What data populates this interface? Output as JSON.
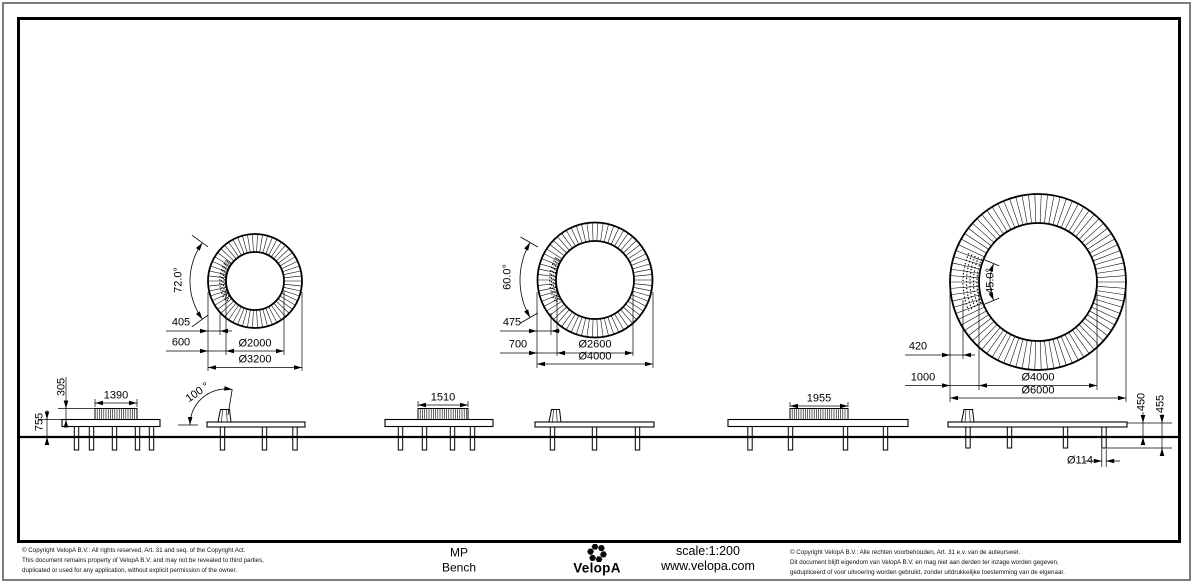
{
  "plan_views": [
    {
      "name": "circular bench plan Ø3200",
      "angle_label": "72.0°",
      "seat_offset": "405",
      "ring_width": "600",
      "inner_diameter": "Ø2000",
      "outer_diameter": "Ø3200"
    },
    {
      "name": "circular bench plan Ø4000",
      "angle_label": "60.0°",
      "seat_offset": "475",
      "ring_width": "700",
      "inner_diameter": "Ø2600",
      "outer_diameter": "Ø4000"
    },
    {
      "name": "circular bench plan Ø6000",
      "angle_label": "45.0°",
      "seat_offset": "420",
      "ring_width": "1000",
      "inner_diameter": "Ø4000",
      "outer_diameter": "Ø6000"
    }
  ],
  "elevations": {
    "backrest_height": "305",
    "overall_height": "755",
    "backrest_angle": "100 °",
    "seat_widths": [
      "1390",
      "1510",
      "1955"
    ],
    "seat_height": "450",
    "seat_height_alt": "455",
    "leg_diameter": "Ø114"
  },
  "title_block": {
    "product_line": "MP",
    "product_type": "Bench",
    "brand": "VelopA",
    "scale": "scale:1:200",
    "website": "www.velopa.com",
    "copyright_en": [
      "©  Copyright VelopA B.V.: All rights reserved, Art. 31 and seq. of the Copyright Act.",
      "This document remains property of VelopA B.V. and may not be revealed to third parties,",
      "duplicated or used for any application, without explicit permission of the owner."
    ],
    "copyright_nl": [
      "©  Copyright VelopA B.V.: Alle rechten voorbehouden, Art. 31 e.v. van de auteurswet.",
      "Dit document blijft eigendom van VelopA B.V. en mag niet aan derden ter inzage worden gegeven,",
      "gedupliceerd of voor uitvoering worden gebruikt, zonder uitdrukkelijke toestemming van de eigenaar."
    ]
  },
  "colors": {
    "line": "#000000",
    "outer_frame": "#7d7d7d"
  }
}
